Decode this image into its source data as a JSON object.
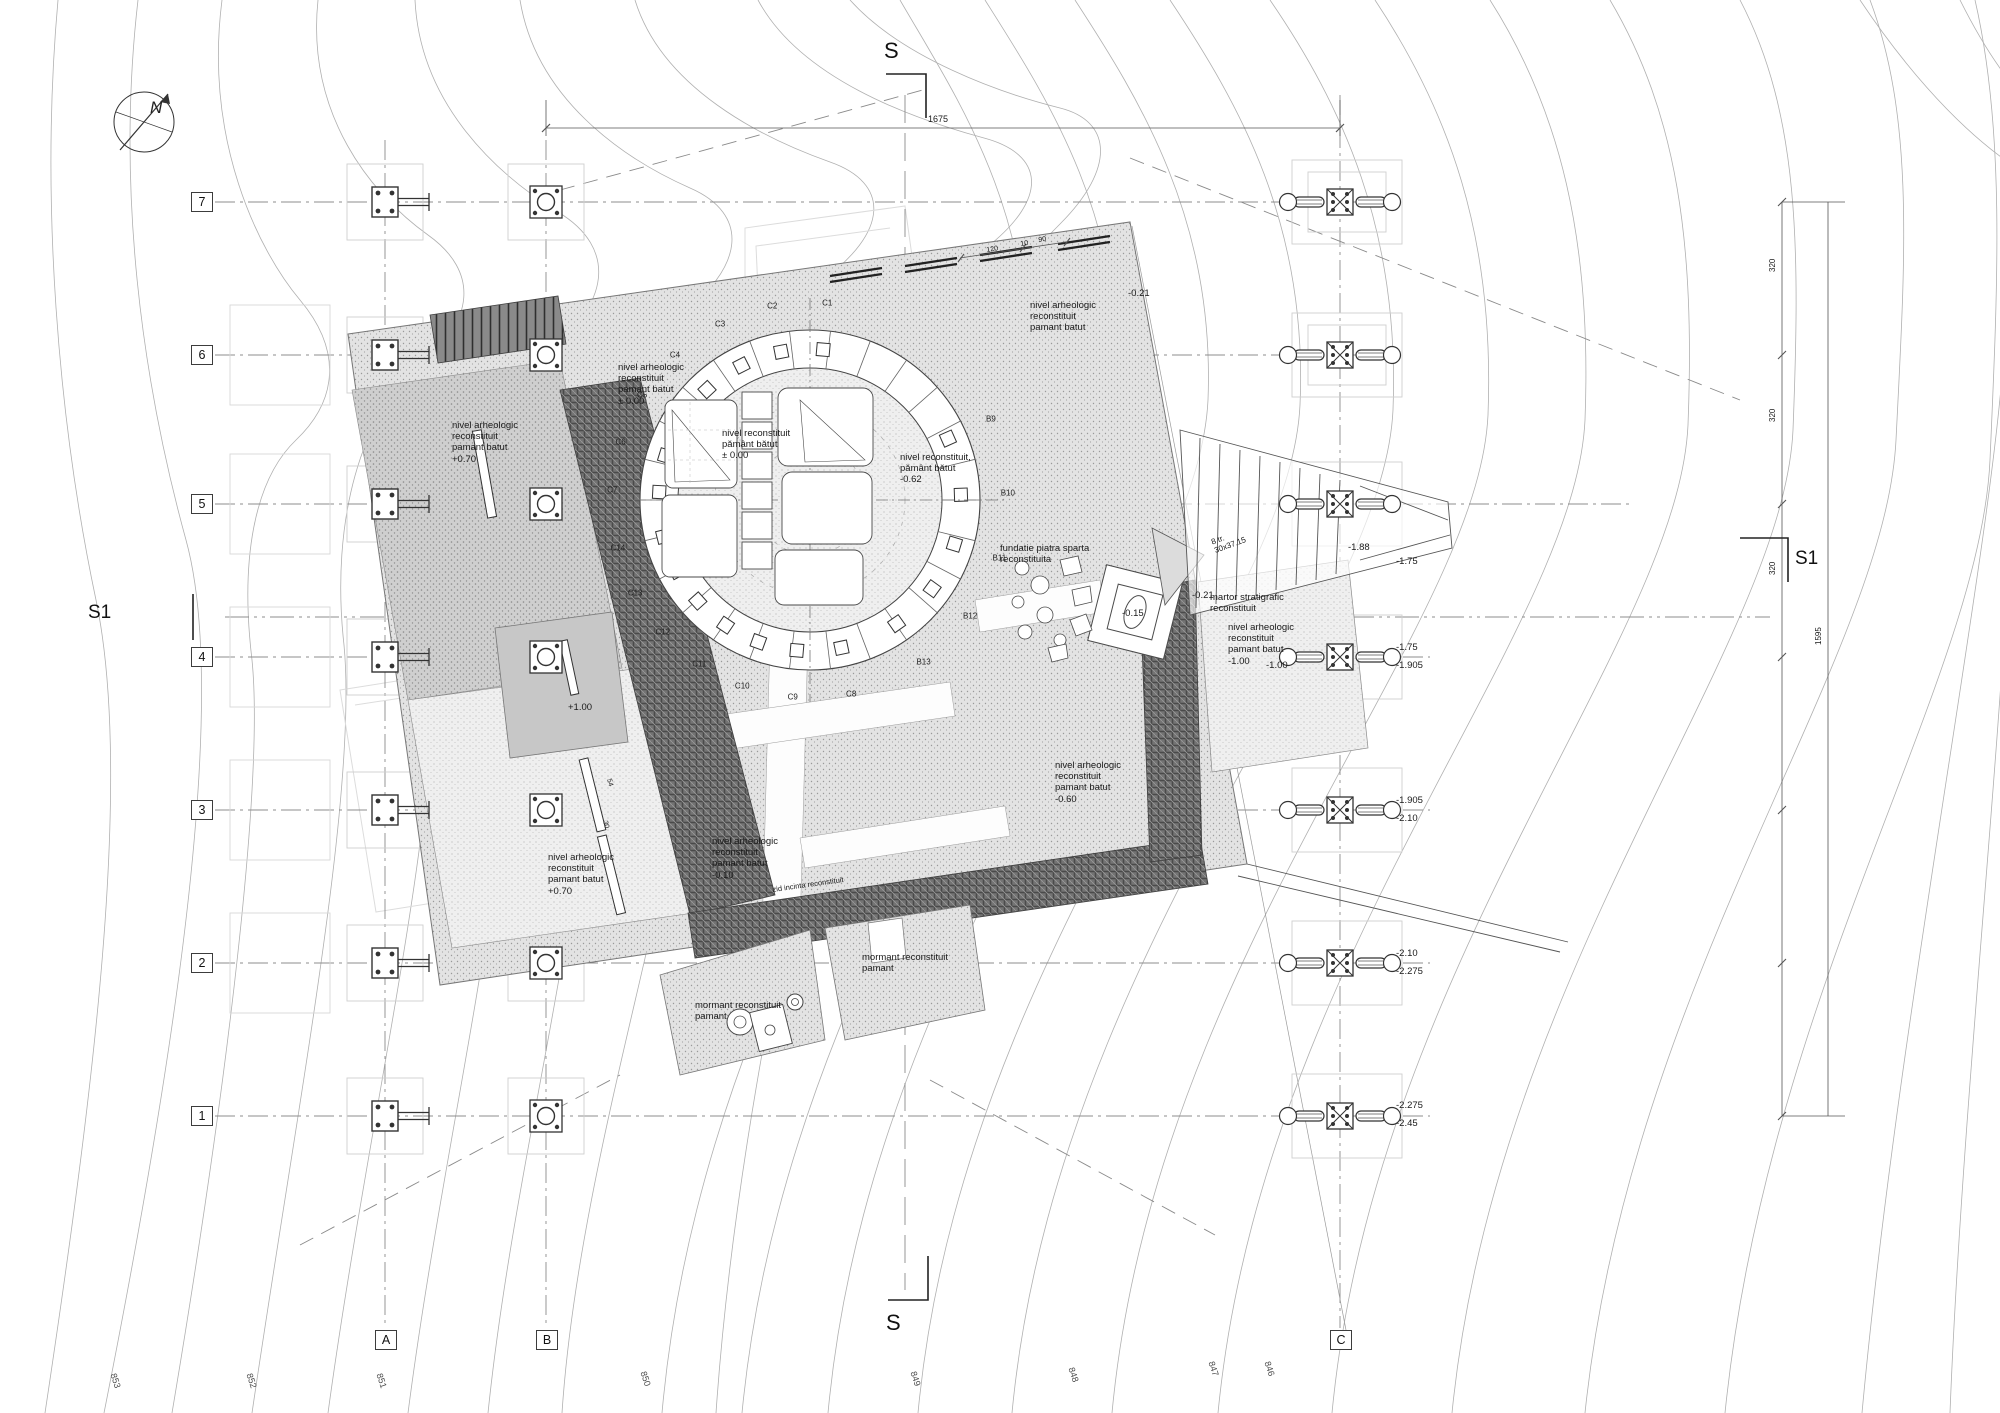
{
  "page": {
    "width": 2000,
    "height": 1413,
    "background": "#ffffff"
  },
  "north_arrow": {
    "label": "N"
  },
  "section_markers": {
    "top": "S",
    "bottom": "S",
    "left": "S1",
    "right": "S1"
  },
  "grid": {
    "rows": [
      {
        "label": "7",
        "y": 202
      },
      {
        "label": "6",
        "y": 355
      },
      {
        "label": "5",
        "y": 504
      },
      {
        "label": "4",
        "y": 657
      },
      {
        "label": "3",
        "y": 810
      },
      {
        "label": "2",
        "y": 963
      },
      {
        "label": "1",
        "y": 1116
      }
    ],
    "cols": [
      {
        "label": "A",
        "x": 385
      },
      {
        "label": "B",
        "x": 546
      },
      {
        "label": "C",
        "x": 1340
      }
    ]
  },
  "ring": {
    "cx": 810,
    "cy": 500,
    "r_outer": 170,
    "r_inner": 132,
    "label_radius": 198,
    "labels": [
      {
        "t": "C1",
        "a": -85
      },
      {
        "t": "C2",
        "a": -101
      },
      {
        "t": "C3",
        "a": -117
      },
      {
        "t": "C4",
        "a": -133
      },
      {
        "t": "C5",
        "a": -148
      },
      {
        "t": "C6",
        "a": -163
      },
      {
        "t": "C7",
        "a": -177
      },
      {
        "t": "C14",
        "a": 166
      },
      {
        "t": "C13",
        "a": 152
      },
      {
        "t": "C12",
        "a": 138
      },
      {
        "t": "C11",
        "a": 124
      },
      {
        "t": "C10",
        "a": 110
      },
      {
        "t": "C9",
        "a": 95
      },
      {
        "t": "C8",
        "a": 78
      },
      {
        "t": "B13",
        "a": 55
      },
      {
        "t": "B12",
        "a": 36
      },
      {
        "t": "B11",
        "a": 17
      },
      {
        "t": "B10",
        "a": -2
      },
      {
        "t": "B9",
        "a": -24
      }
    ]
  },
  "annotations": [
    {
      "t": "nivel arheologic\nreconstituit\npamant batut\n+0.70",
      "x": 452,
      "y": 420
    },
    {
      "t": "nivel arheologic\nreconstituit\npamant batut\n± 0.00",
      "x": 618,
      "y": 362
    },
    {
      "t": "nivel arheologic\nreconstituit\npamant batut",
      "x": 1030,
      "y": 300
    },
    {
      "t": "nivel reconstituit\npământ bătut\n± 0.00",
      "x": 722,
      "y": 428
    },
    {
      "t": "nivel reconstituit,\npământ bătut\n-0.62",
      "x": 900,
      "y": 452
    },
    {
      "t": "fundatie piatra sparta\nreconstituita",
      "x": 1000,
      "y": 543
    },
    {
      "t": "martor stratigrafic\nreconstituit",
      "x": 1210,
      "y": 592
    },
    {
      "t": "nivel arheologic\nreconstituit\npamant batut\n-1.00",
      "x": 1228,
      "y": 622
    },
    {
      "t": "-1.00",
      "x": 1266,
      "y": 660
    },
    {
      "t": "nivel arheologic\nreconstituit\npamant batut\n-0.60",
      "x": 1055,
      "y": 760
    },
    {
      "t": "nivel arheologic\nreconstituit\npamant batut\n-0.10",
      "x": 712,
      "y": 836
    },
    {
      "t": "nivel arheologic\nreconstituit\npamant batut\n+0.70",
      "x": 548,
      "y": 852
    },
    {
      "t": "mormant reconstituit\npamant",
      "x": 695,
      "y": 1000
    },
    {
      "t": "mormant reconstituit\npamant",
      "x": 862,
      "y": 952
    },
    {
      "t": "+1.00",
      "x": 568,
      "y": 702
    },
    {
      "t": "-0.21",
      "x": 1128,
      "y": 288
    },
    {
      "t": "-0.21",
      "x": 1192,
      "y": 590
    },
    {
      "t": "-0.15",
      "x": 1122,
      "y": 608
    },
    {
      "t": "-1.88",
      "x": 1348,
      "y": 542
    },
    {
      "t": "-1.75",
      "x": 1396,
      "y": 556
    },
    {
      "t": "-1.75",
      "x": 1396,
      "y": 642
    },
    {
      "t": "-1.905",
      "x": 1396,
      "y": 660
    },
    {
      "t": "-1.905",
      "x": 1396,
      "y": 795
    },
    {
      "t": "-2.10",
      "x": 1396,
      "y": 813
    },
    {
      "t": "-2.10",
      "x": 1396,
      "y": 948
    },
    {
      "t": "-2.275",
      "x": 1396,
      "y": 966
    },
    {
      "t": "-2.275",
      "x": 1396,
      "y": 1100
    },
    {
      "t": "-2.45",
      "x": 1396,
      "y": 1118
    },
    {
      "t": "8 tr.\n30x37.15",
      "x": 1210,
      "y": 538,
      "rot": -20,
      "size": 8
    },
    {
      "t": "1675",
      "x": 928,
      "y": 114,
      "size": 9
    },
    {
      "t": "120",
      "x": 986,
      "y": 247,
      "rot": -9,
      "size": 7
    },
    {
      "t": "10",
      "x": 1020,
      "y": 241,
      "rot": -9,
      "size": 7
    },
    {
      "t": "90",
      "x": 1038,
      "y": 237,
      "rot": -9,
      "size": 7
    },
    {
      "t": "320",
      "x": 1768,
      "y": 272,
      "rot": -90,
      "size": 8
    },
    {
      "t": "320",
      "x": 1768,
      "y": 422,
      "rot": -90,
      "size": 8
    },
    {
      "t": "320",
      "x": 1768,
      "y": 575,
      "rot": -90,
      "size": 8
    },
    {
      "t": "1595",
      "x": 1814,
      "y": 645,
      "rot": -90,
      "size": 8
    },
    {
      "t": "54",
      "x": 612,
      "y": 778,
      "rot": 75,
      "size": 7
    },
    {
      "t": "30",
      "x": 608,
      "y": 820,
      "rot": 75,
      "size": 7
    },
    {
      "t": "zid incinta reconstituit",
      "x": 772,
      "y": 886,
      "rot": -8,
      "size": 7.5
    }
  ],
  "contour_labels": [
    {
      "t": "853",
      "x": 118,
      "y": 1372
    },
    {
      "t": "852",
      "x": 254,
      "y": 1372
    },
    {
      "t": "851",
      "x": 384,
      "y": 1372
    },
    {
      "t": "850",
      "x": 648,
      "y": 1370
    },
    {
      "t": "849",
      "x": 918,
      "y": 1370
    },
    {
      "t": "848",
      "x": 1076,
      "y": 1366
    },
    {
      "t": "847",
      "x": 1216,
      "y": 1360
    },
    {
      "t": "846",
      "x": 1272,
      "y": 1360
    }
  ],
  "colors": {
    "contour": "#b3b3b3",
    "grid_line": "#8c8c8c",
    "wall_dark": "#6e6e6e",
    "stipple_bg": "#e3e3e3",
    "text": "#1a1a1a"
  }
}
